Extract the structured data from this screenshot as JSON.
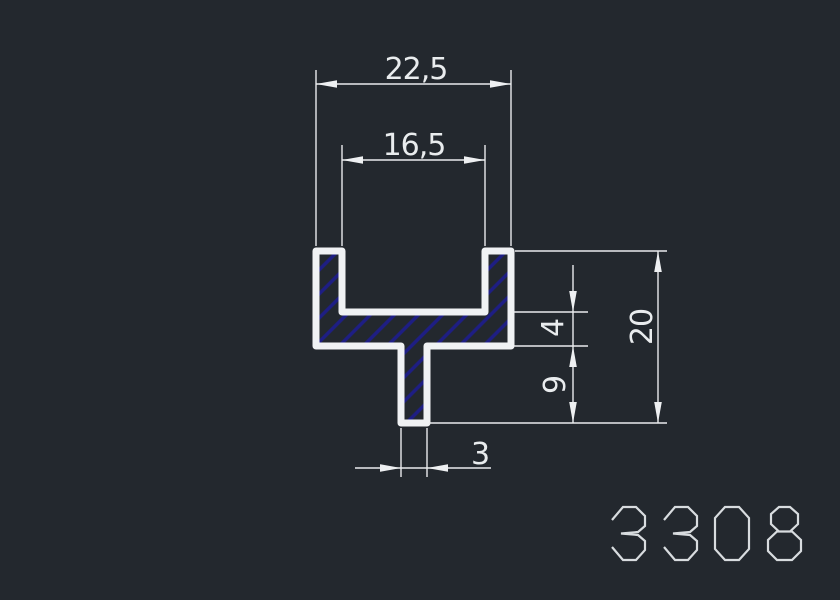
{
  "drawing": {
    "profile_number": "3308",
    "dimensions": {
      "outer_width": "22,5",
      "inner_width": "16,5",
      "web_thickness": "4",
      "stem_depth": "9",
      "total_height": "20",
      "stem_width": "3"
    },
    "colors": {
      "background": "#23282e",
      "profile_outline": "#f0f2f4",
      "dimension_lines": "#e9ebed",
      "hatch_blue": "#1e1e84",
      "profile_number_text": "#d8dcdf"
    }
  }
}
